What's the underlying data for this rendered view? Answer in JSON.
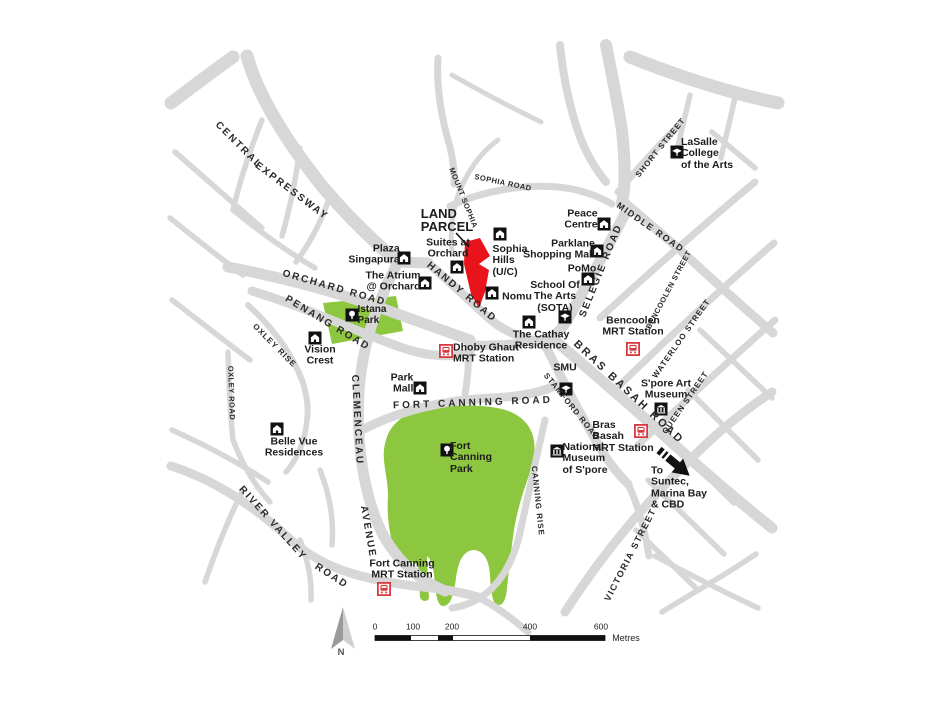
{
  "colors": {
    "road": "#d7d7d7",
    "park": "#8dc63f",
    "parcel": "#e8131b",
    "mrt_red": "#d93a40",
    "text": "#1d1d1b"
  },
  "parcel": {
    "label": "LAND\nPARCEL"
  },
  "roads": {
    "central_1": "CENTRAL",
    "central_2": "EXPRESSWAY",
    "orchard": "ORCHARD ROAD",
    "penang": "PENANG ROAD",
    "handy": "HANDY ROAD",
    "mount_sophia": "MOUNT SOPHIA",
    "sophia": "SOPHIA ROAD",
    "selegie": "SELEGIE ROAD",
    "middle": "MIDDLE ROAD",
    "short": "SHORT STREET",
    "bencoolen": "BENCOOLEN STREET",
    "waterloo": "WATERLOO STREET",
    "queen": "QUEEN STREET",
    "bras_basah": "BRAS BASAH ROAD",
    "stamford": "STAMFORD ROAD",
    "fort_canning": "FORT CANNING ROAD",
    "canning_rise": "CANNING RISE",
    "clemenceau": "CLEMENCEAU",
    "avenue": "AVENUE",
    "river_valley_1": "RIVER VALLEY",
    "river_valley_2": "ROAD",
    "oxley_rise": "OXLEY RISE",
    "oxley_road": "OXLEY ROAD",
    "victoria": "VICTORIA STREET"
  },
  "places": {
    "plaza_singapura": "Plaza\nSingapura",
    "atrium": "The Atrium\n@ Orchard",
    "suites_at_orchard": "Suites at\nOrchard",
    "sophia_hills": "Sophia\nHills\n(U/C)",
    "nomu": "Nomu",
    "peace_centre": "Peace\nCentre",
    "parklane": "Parklane\nShopping Mall",
    "pomo": "PoMo",
    "sota": "School Of\nThe Arts\n(SOTA)",
    "lasalle": "LaSalle\nCollege\nof the Arts",
    "cathay": "The Cathay\nResidence",
    "smu": "SMU",
    "art_museum": "S'pore Art\nMuseum",
    "national_museum": "National\nMuseum\nof S'pore",
    "vision_crest": "Vision\nCrest",
    "belle_vue": "Belle Vue\nResidences",
    "istana_park": "Istana\nPark",
    "fort_canning_park": "Fort\nCanning\nPark",
    "park_mall": "Park\nMall",
    "to_suntec": "To\nSuntec,\nMarina Bay\n& CBD"
  },
  "stations": {
    "dhoby_ghaut": "Dhoby Ghaut\nMRT Station",
    "bencoolen": "Bencoolen\nMRT Station",
    "bras_basah": "Bras\nBasah\nMRT Station",
    "fort_canning": "Fort Canning\nMRT Station"
  },
  "legend": {
    "north": "N",
    "ticks": [
      "0",
      "100",
      "200",
      "400",
      "600"
    ],
    "unit": "Metres"
  }
}
